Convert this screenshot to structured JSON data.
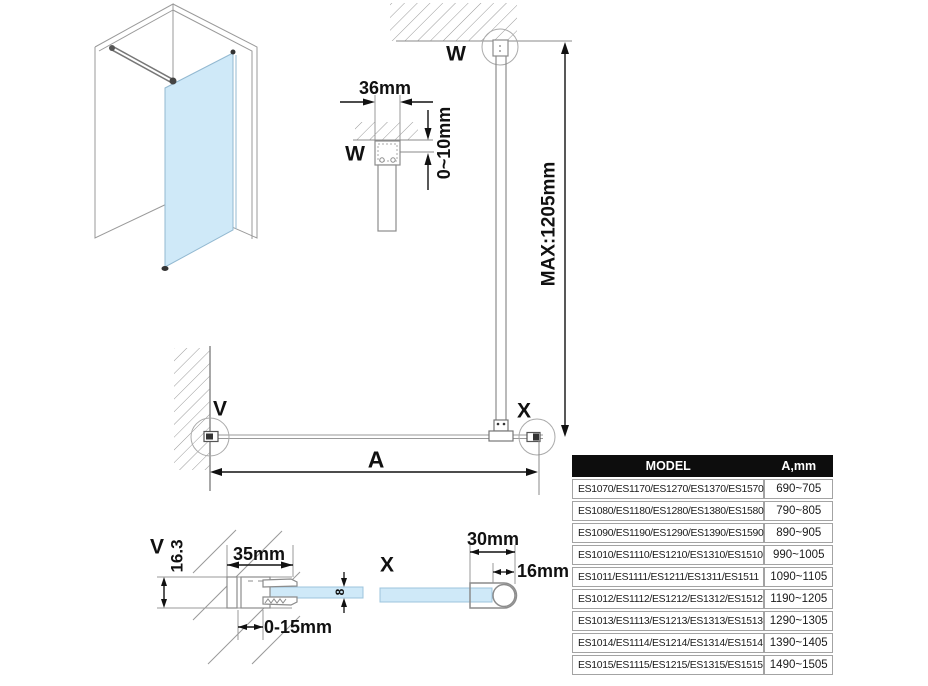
{
  "drawing": {
    "detail_labels": {
      "w_elevation": "W",
      "w_plan": "W",
      "v_plan": "V",
      "x_plan": "X",
      "v_section": "V",
      "x_section": "X"
    },
    "dimensions": {
      "bracket_width": "36mm",
      "ceiling_gap": "0~10mm",
      "max_bar_length": "MAX:1205mm",
      "glass_width": "A",
      "wall_profile_width": "35mm",
      "wall_profile_depth": "16.3",
      "wall_adjustment": "0-15mm",
      "glass_thickness": "8",
      "end_profile_width": "30mm",
      "end_profile_diameter": "16mm"
    },
    "colors": {
      "glass": "#cfe9f8",
      "glass_border": "#9cc4dd",
      "profile_line": "#8c8c8c",
      "dimension_line": "#111111"
    }
  },
  "table": {
    "headers": {
      "model": "MODEL",
      "a_mm": "A,mm"
    },
    "rows": [
      {
        "model": "ES1070/ES1170/ES1270/ES1370/ES1570",
        "a": "690~705"
      },
      {
        "model": "ES1080/ES1180/ES1280/ES1380/ES1580",
        "a": "790~805"
      },
      {
        "model": "ES1090/ES1190/ES1290/ES1390/ES1590",
        "a": "890~905"
      },
      {
        "model": "ES1010/ES1110/ES1210/ES1310/ES1510",
        "a": "990~1005"
      },
      {
        "model": "ES1011/ES1111/ES1211/ES1311/ES1511",
        "a": "1090~1105"
      },
      {
        "model": "ES1012/ES1112/ES1212/ES1312/ES1512",
        "a": "1190~1205"
      },
      {
        "model": "ES1013/ES1113/ES1213/ES1313/ES1513",
        "a": "1290~1305"
      },
      {
        "model": "ES1014/ES1114/ES1214/ES1314/ES1514",
        "a": "1390~1405"
      },
      {
        "model": "ES1015/ES1115/ES1215/ES1315/ES1515",
        "a": "1490~1505"
      }
    ]
  }
}
